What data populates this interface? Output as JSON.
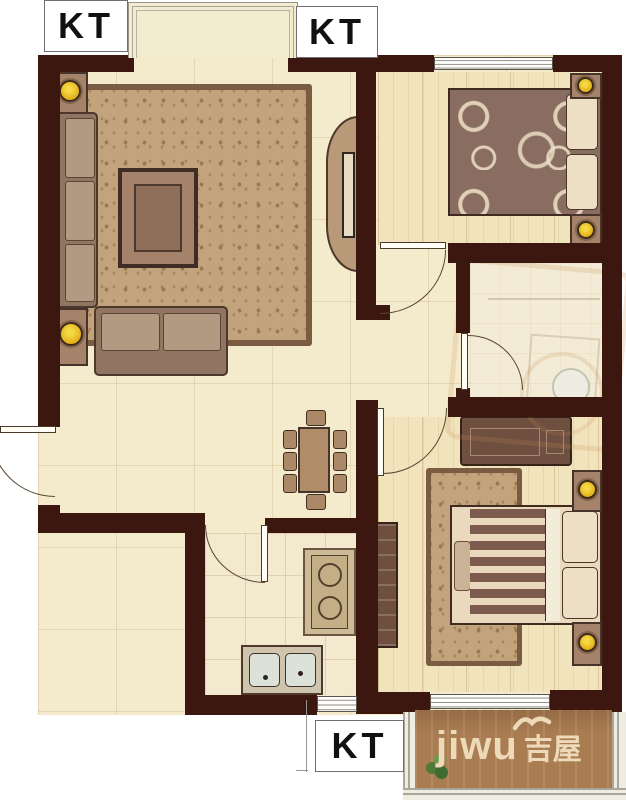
{
  "labels": {
    "kt_top_left": "KT",
    "kt_top_center": "KT",
    "kt_bottom": "KT"
  },
  "watermark": {
    "brand_latin": "jiwu",
    "brand_cjk": "吉屋"
  },
  "palette": {
    "wall": "#3B1710",
    "floor": "#F4EBCD",
    "plank_floor": "#F1E3BC",
    "rug": "#C3A37B",
    "furniture_wood": "#A5826A",
    "balcony_floor": "#A97C52",
    "lamp_yellow": "#E8BD20",
    "watermark_text": "#ECDAB8",
    "window_line": "#8F8A80"
  }
}
